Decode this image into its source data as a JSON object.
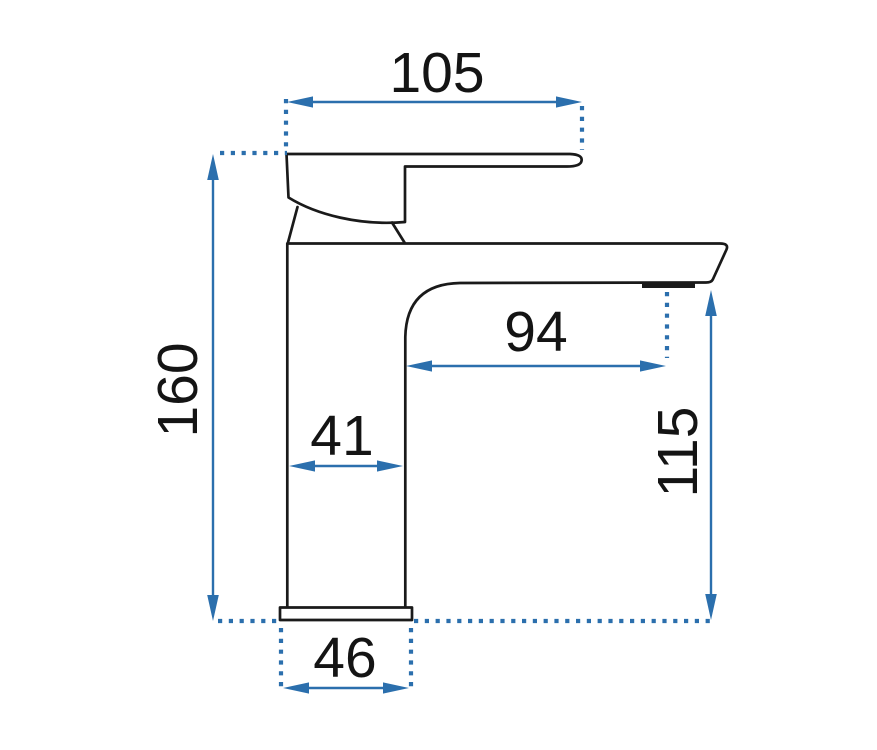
{
  "drawing": {
    "background_color": "#ffffff",
    "outline_color": "#1a1a1a",
    "dimension_color": "#2b6fad",
    "label_color": "#141414"
  },
  "dimensions": {
    "spout_top_width": "105",
    "overall_height": "160",
    "spout_reach": "94",
    "body_depth": "41",
    "spout_outlet_height": "115",
    "base_width": "46"
  }
}
